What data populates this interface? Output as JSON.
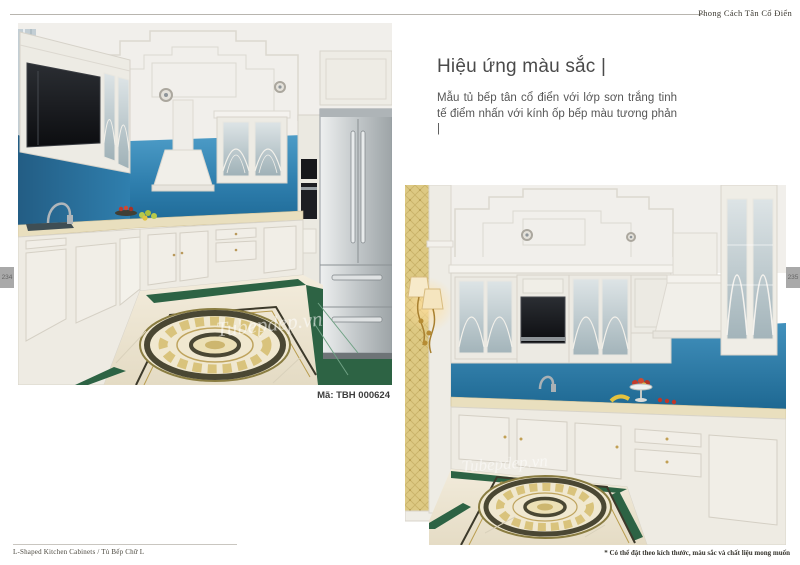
{
  "header": {
    "title": "Phong Cách Tân Cổ Điển"
  },
  "side_tabs": {
    "left_page": "234",
    "right_page": "235"
  },
  "section": {
    "heading": "Hiệu ứng màu sắc |",
    "body": "Mẫu tủ bếp tân cổ điển với lớp sơn trắng tinh tế điểm nhấn với kính ốp bếp màu tương phản |"
  },
  "photos": {
    "photo1": {
      "caption": "Mã: TBH 000624",
      "watermark": "Tubepdep.vn"
    },
    "photo2": {
      "watermark": "Tubepdep.vn"
    }
  },
  "footer": {
    "left": "L-Shaped Kitchen Cabinets / Tủ Bếp Chữ L",
    "right": "* Có thể đặt theo kích thước, màu sắc và chất liệu mong muốn"
  },
  "colors": {
    "backsplash_blue": "#2e7fae",
    "cabinet_white": "#edebe4",
    "counter_cream": "#e9dfbe",
    "floor_cream": "#ece4d0",
    "floor_green": "#2d6344",
    "medallion_gold": "#d9c37c",
    "wallpaper_gold": "#ddc983",
    "stainless_steel": "#b3b9bc",
    "page_tab_gray": "#a9a9a9"
  }
}
